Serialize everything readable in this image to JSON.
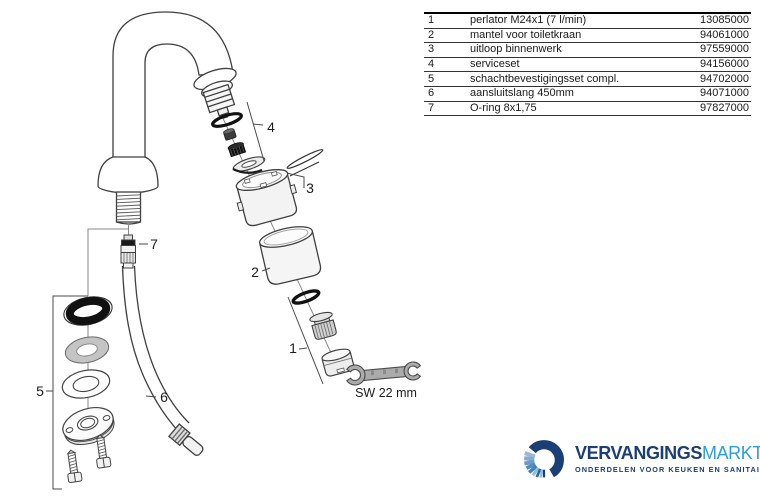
{
  "parts_table": {
    "rows": [
      {
        "ref": "1",
        "description": "perlator M24x1 (7 l/min)",
        "part_number": "13085000"
      },
      {
        "ref": "2",
        "description": "mantel voor toiletkraan",
        "part_number": "94061000"
      },
      {
        "ref": "3",
        "description": "uitloop binnenwerk",
        "part_number": "97559000"
      },
      {
        "ref": "4",
        "description": "serviceset",
        "part_number": "94156000"
      },
      {
        "ref": "5",
        "description": "schachtbevestigingsset compl.",
        "part_number": "94702000"
      },
      {
        "ref": "6",
        "description": "aansluitslang 450mm",
        "part_number": "94071000"
      },
      {
        "ref": "7",
        "description": "O-ring 8x1,75",
        "part_number": "97827000"
      }
    ]
  },
  "diagram": {
    "callouts": {
      "c1": "1",
      "c2": "2",
      "c3": "3",
      "c4": "4",
      "c5": "5",
      "c6": "6",
      "c7": "7"
    },
    "wrench_label": "SW 22 mm"
  },
  "logo": {
    "brand_bold": "VERVANGINGS",
    "brand_light": "MARKT",
    "tagline": "ONDERDELEN VOOR KEUKEN EN SANITAIR",
    "colors": {
      "dark_blue": "#1b3e74",
      "light_blue": "#2d9fd8"
    }
  }
}
